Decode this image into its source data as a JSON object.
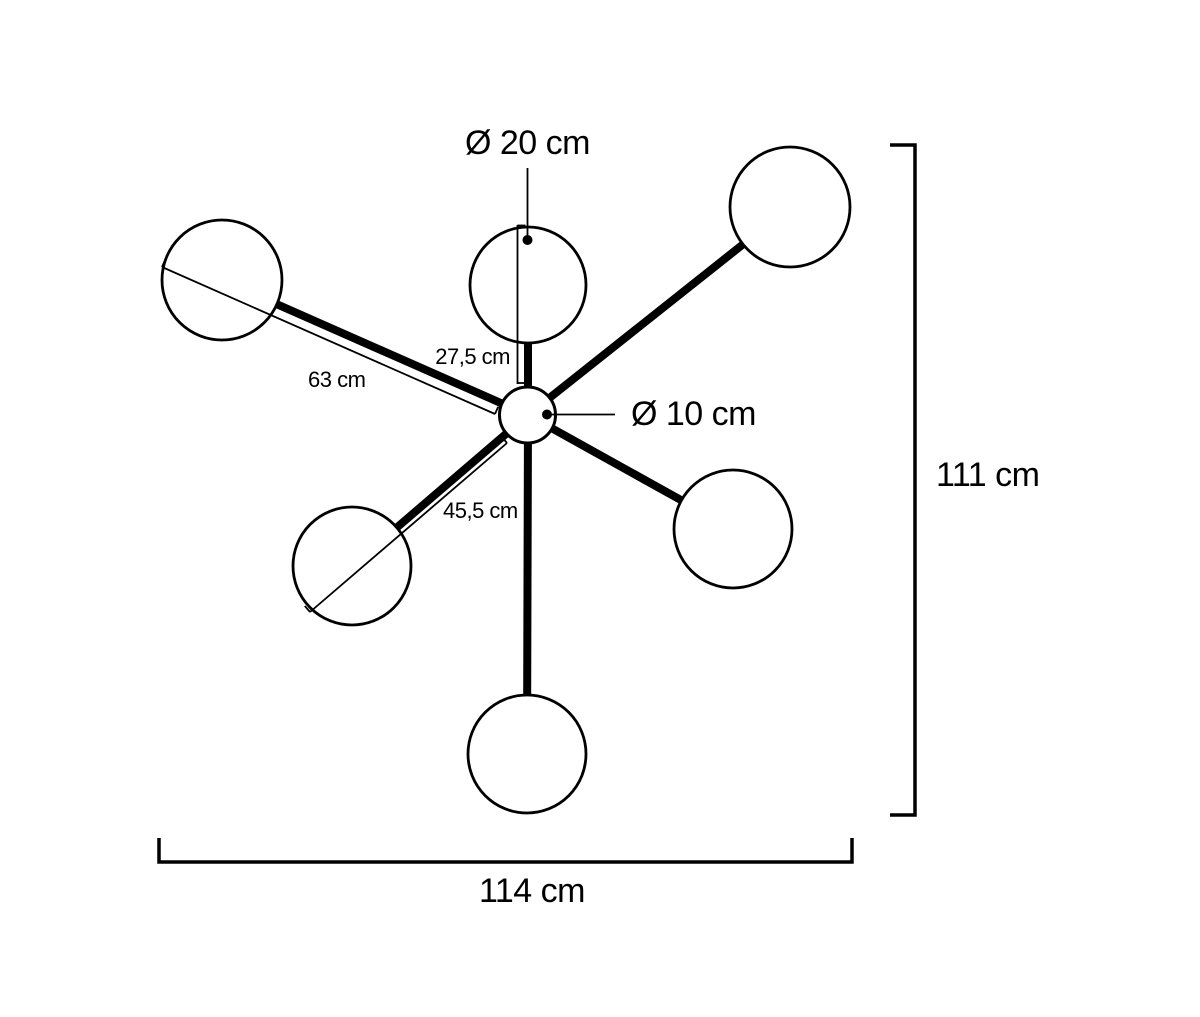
{
  "figure": {
    "type": "dimension-diagram",
    "subject": "6-globe chandelier lamp, top view with dimensions",
    "globe_count": 6,
    "ink_color": "#000000",
    "background_color": "#ffffff",
    "labels": {
      "globe_diameter": "Ø 20 cm",
      "hub_diameter": "Ø 10 cm",
      "top_arm_length": "27,5 cm",
      "long_arm_length": "63 cm",
      "short_arm_length": "45,5 cm",
      "overall_height": "111 cm",
      "overall_width": "114 cm"
    },
    "values_cm": {
      "globe_diameter": 20,
      "hub_diameter": 10,
      "top_arm_length": 27.5,
      "long_arm_length": 63,
      "short_arm_length": 45.5,
      "overall_height": 111,
      "overall_width": 114
    }
  }
}
